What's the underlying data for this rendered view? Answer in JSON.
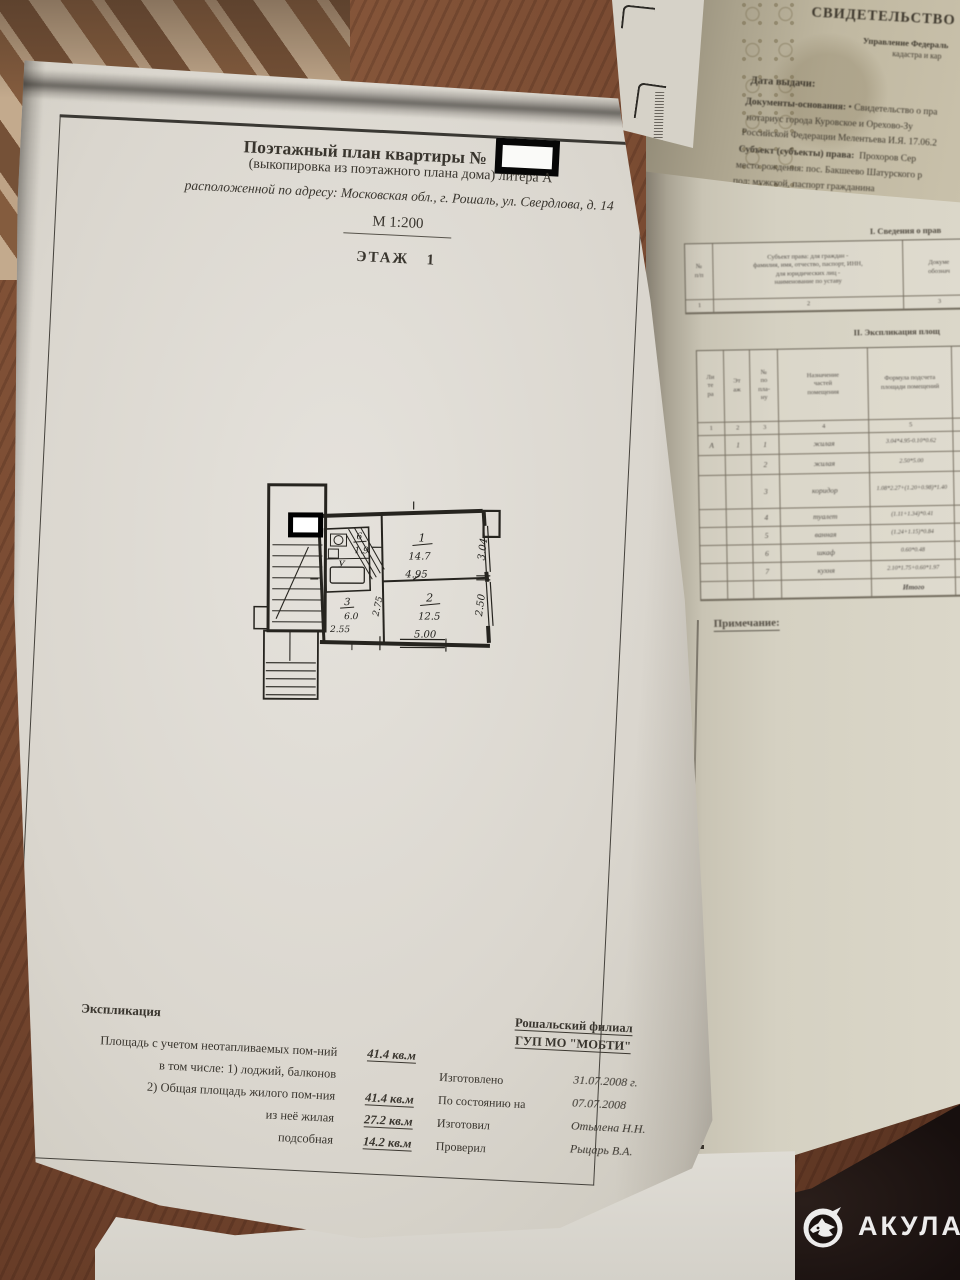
{
  "main_page": {
    "header": {
      "title": "Поэтажный план квартиры №",
      "subtitle": "(выкопировка из поэтажного плана дома) литера А",
      "address": "расположенной по адресу: Московская обл., г. Рошаль, ул. Свердлова, д. 14",
      "scale": "М 1:200",
      "floor": "ЭТАЖ   1"
    },
    "plan": {
      "rooms": [
        {
          "num": "1",
          "area": "14.7",
          "w": "4.95",
          "h": "3.04"
        },
        {
          "num": "2",
          "area": "12.5",
          "w": "5.00",
          "h": "2.50"
        },
        {
          "num": "3",
          "area": "6.0",
          "w": "2.55",
          "h": "2.75"
        },
        {
          "num": "6",
          "area": "1.9"
        }
      ],
      "bath_mark": "У"
    },
    "explication": {
      "heading": "Экспликация",
      "rows": [
        {
          "label": "Площадь с учетом неотапливаемых пом-ний",
          "value": "41.4 кв.м"
        },
        {
          "label": "в том числе: 1) лоджий, балконов",
          "value": ""
        },
        {
          "label": "2) Общая площадь жилого пом-ния",
          "value": "41.4 кв.м"
        },
        {
          "label": "из неё жилая",
          "value": "27.2 кв.м"
        },
        {
          "label": "подсобная",
          "value": "14.2 кв.м"
        }
      ]
    },
    "issuer": {
      "org1": "Рошальский филиал",
      "org2": "ГУП МО \"МОБТИ\"",
      "rows": [
        {
          "label": "Изготовлено",
          "value": "31.07.2008 г."
        },
        {
          "label": "По состоянию на",
          "value": "07.07.2008"
        },
        {
          "label": "Изготовил",
          "value": "Отылена Н.Н."
        },
        {
          "label": "Проверил",
          "value": "Рыцарь В.А."
        }
      ]
    }
  },
  "certificate": {
    "title": "СВИДЕТЕЛЬСТВО О ГОС",
    "subtitle1": "Управление Федераль",
    "subtitle2": "кадастра и кар",
    "date_label": "Дата выдачи:",
    "docs_label": "Документы-основания:",
    "docs_rest": "• Свидетельство о пра",
    "line2": "нотариус города Куровское и Орехово-Зу",
    "line3": "Российской Федерации Мелентьева И.Я. 17.06.2",
    "subject_label": "Субъект (субъекты) права:",
    "subject_rest": "Прохоров Сер",
    "line5": "место рождения: пос. Бакшеево Шатурского р",
    "line6": "пол: мужской, паспорт гражданина"
  },
  "tables_page": {
    "section1_title": "I. Сведения о прав",
    "table1": {
      "col1": "№\nп/п",
      "col2": "Субъект права: для граждан -\nфамилия, имя, отчество, паспорт, ИНН,\nдля юридических лиц -\nнаименование по уставу",
      "col3": "Докуме\nобознач",
      "nums": [
        "1",
        "2",
        "3"
      ]
    },
    "section2_title": "II. Экспликация площ",
    "table2": {
      "headers": [
        "Ли\nте\nра",
        "Эт\nаж",
        "№\nпо\nпла-\nну",
        "Назначение\nчастей\nпомещения",
        "Формула подсчета\nплощади помещений",
        "Площадь\nс учетом\nнеотапл.\nпом-ний"
      ],
      "nums": [
        "1",
        "2",
        "3",
        "4",
        "5",
        "6"
      ],
      "rows": [
        [
          "А",
          "1",
          "1",
          "жилая",
          "3.04*4.95-0.10*0.62",
          "14.7"
        ],
        [
          "",
          "",
          "2",
          "жилая",
          "2.50*5.00",
          "12.5"
        ],
        [
          "",
          "",
          "3",
          "коридор",
          "1.08*2.27+(1.20+0.98)*1.40",
          "6.0"
        ],
        [
          "",
          "",
          "4",
          "туалет",
          "(1.11+1.34)*0.41",
          "1.0"
        ],
        [
          "",
          "",
          "5",
          "ванная",
          "(1.24+1.15)*0.84",
          "2.0"
        ],
        [
          "",
          "",
          "6",
          "шкаф",
          "0.60*0.48",
          "0.3"
        ],
        [
          "",
          "",
          "7",
          "кухня",
          "2.10*1.75+0.60*1.97",
          "4.9"
        ],
        [
          "",
          "",
          "",
          "",
          "Итого",
          "41."
        ]
      ]
    },
    "note_label": "Примечание:"
  },
  "watermark": {
    "brand": "АКУЛА"
  }
}
